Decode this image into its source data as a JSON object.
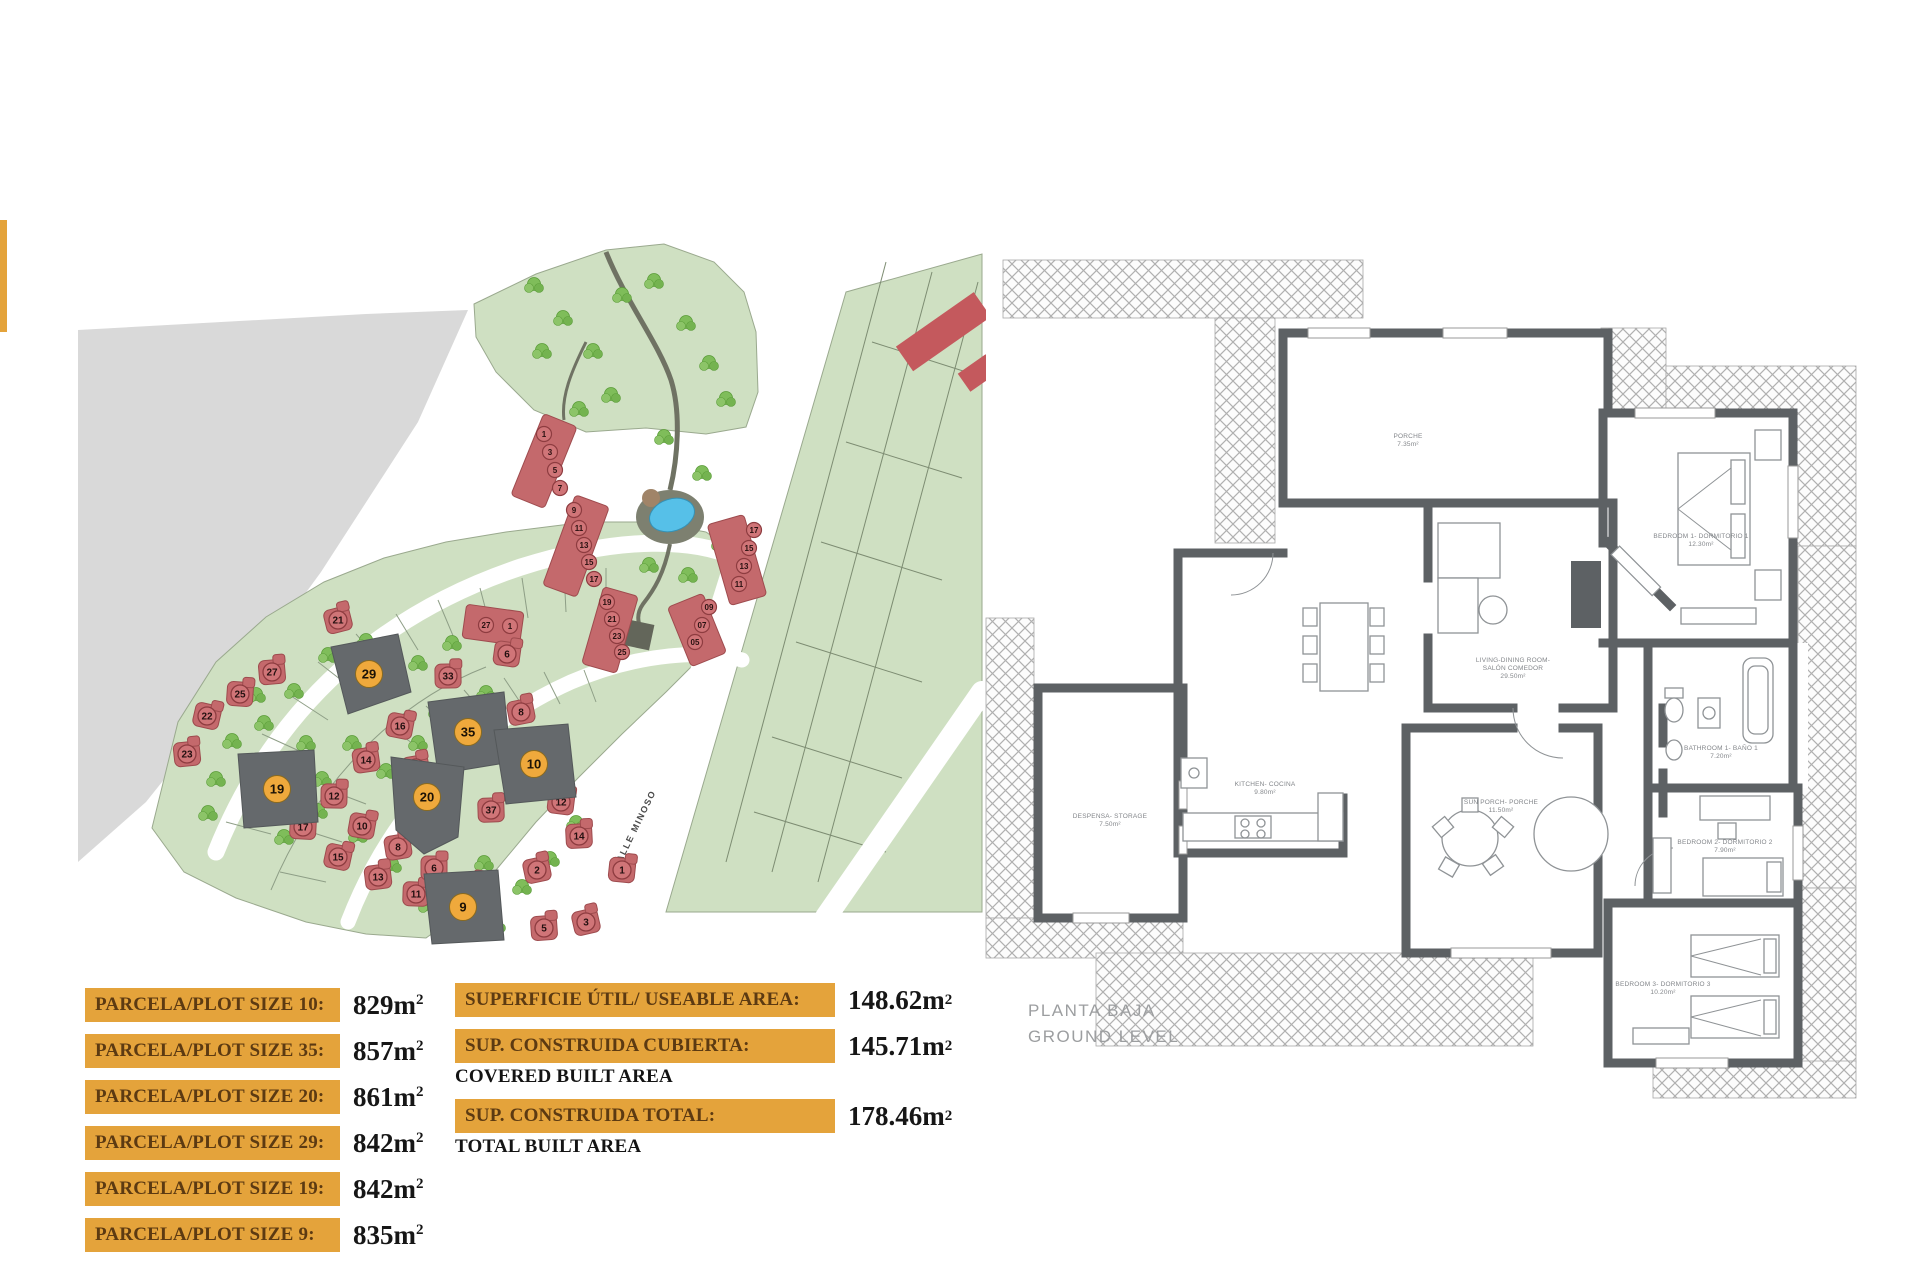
{
  "colors": {
    "table_orange": "#E4A33B",
    "table_text": "#5C3A12",
    "value_text": "#161616",
    "site_green": "#cfe0c2",
    "site_gray": "#d9d9d9",
    "house_red": "#c4696c",
    "marker_orange": "#EFA93C",
    "dark_plot": "#65696c",
    "pool_blue": "#56c0e8",
    "wall": "#5d6164",
    "hatch": "#b0b0b0",
    "label_gray": "#83868a",
    "title_gray": "#9c9ea0"
  },
  "plot_table": {
    "rows": [
      {
        "label": "PARCELA/PLOT SIZE 10:",
        "value": "829",
        "unit": "m",
        "sup": "2"
      },
      {
        "label": "PARCELA/PLOT SIZE 35:",
        "value": "857",
        "unit": "m",
        "sup": "2"
      },
      {
        "label": "PARCELA/PLOT SIZE 20:",
        "value": "861",
        "unit": "m",
        "sup": "2"
      },
      {
        "label": "PARCELA/PLOT SIZE 29:",
        "value": "842",
        "unit": "m",
        "sup": "2"
      },
      {
        "label": "PARCELA/PLOT SIZE 19:",
        "value": "842",
        "unit": "m",
        "sup": "2"
      },
      {
        "label": "PARCELA/PLOT SIZE 9:",
        "value": "835",
        "unit": "m",
        "sup": "2"
      }
    ]
  },
  "area_table": {
    "rows": [
      {
        "label": "SUPERFICIE ÚTIL/ USEABLE AREA:",
        "sublabel": "",
        "value": "148.62",
        "unit": "m",
        "sup": "2"
      },
      {
        "label": "SUP. CONSTRUIDA CUBIERTA:",
        "sublabel": "COVERED BUILT AREA",
        "value": "145.71",
        "unit": "m",
        "sup": "2"
      },
      {
        "label": "SUP. CONSTRUIDA TOTAL:",
        "sublabel": "TOTAL BUILT AREA",
        "value": "178.46",
        "unit": "m",
        "sup": "2"
      }
    ]
  },
  "site_plan": {
    "street_label": "CALLE MINOSO",
    "highlighted_plots": [
      "29",
      "35",
      "10",
      "20",
      "19",
      "9"
    ],
    "house_markers": [
      {
        "n": "21",
        "x": 272,
        "y": 398
      },
      {
        "n": "27",
        "x": 206,
        "y": 450
      },
      {
        "n": "25",
        "x": 174,
        "y": 472
      },
      {
        "n": "22",
        "x": 141,
        "y": 494
      },
      {
        "n": "23",
        "x": 121,
        "y": 532
      },
      {
        "n": "17",
        "x": 237,
        "y": 605
      },
      {
        "n": "15",
        "x": 272,
        "y": 635
      },
      {
        "n": "13",
        "x": 312,
        "y": 655
      },
      {
        "n": "11",
        "x": 350,
        "y": 672
      },
      {
        "n": "16",
        "x": 334,
        "y": 504
      },
      {
        "n": "14",
        "x": 300,
        "y": 538
      },
      {
        "n": "12",
        "x": 268,
        "y": 574
      },
      {
        "n": "10",
        "x": 296,
        "y": 604
      },
      {
        "n": "8",
        "x": 332,
        "y": 625
      },
      {
        "n": "6",
        "x": 368,
        "y": 646
      },
      {
        "n": "4",
        "x": 404,
        "y": 664
      },
      {
        "n": "18",
        "x": 350,
        "y": 546
      },
      {
        "n": "33",
        "x": 382,
        "y": 454
      },
      {
        "n": "6",
        "x": 441,
        "y": 432
      },
      {
        "n": "8",
        "x": 455,
        "y": 490
      },
      {
        "n": "37",
        "x": 425,
        "y": 588
      },
      {
        "n": "12",
        "x": 495,
        "y": 580
      },
      {
        "n": "2",
        "x": 471,
        "y": 648
      },
      {
        "n": "14",
        "x": 513,
        "y": 614
      },
      {
        "n": "1",
        "x": 556,
        "y": 648
      },
      {
        "n": "3",
        "x": 520,
        "y": 700
      },
      {
        "n": "5",
        "x": 478,
        "y": 706
      }
    ],
    "townhouse_units": [
      {
        "n": "1",
        "x": 478,
        "y": 212
      },
      {
        "n": "3",
        "x": 484,
        "y": 230
      },
      {
        "n": "5",
        "x": 489,
        "y": 248
      },
      {
        "n": "7",
        "x": 494,
        "y": 266
      },
      {
        "n": "9",
        "x": 508,
        "y": 288
      },
      {
        "n": "11",
        "x": 513,
        "y": 306
      },
      {
        "n": "13",
        "x": 518,
        "y": 323
      },
      {
        "n": "15",
        "x": 523,
        "y": 340
      },
      {
        "n": "17",
        "x": 528,
        "y": 357
      },
      {
        "n": "19",
        "x": 541,
        "y": 380
      },
      {
        "n": "21",
        "x": 546,
        "y": 397
      },
      {
        "n": "23",
        "x": 551,
        "y": 414
      },
      {
        "n": "25",
        "x": 556,
        "y": 430
      },
      {
        "n": "17",
        "x": 688,
        "y": 308
      },
      {
        "n": "15",
        "x": 683,
        "y": 326
      },
      {
        "n": "13",
        "x": 678,
        "y": 344
      },
      {
        "n": "11",
        "x": 673,
        "y": 362
      },
      {
        "n": "09",
        "x": 643,
        "y": 385
      },
      {
        "n": "07",
        "x": 636,
        "y": 403
      },
      {
        "n": "05",
        "x": 629,
        "y": 420
      },
      {
        "n": "27",
        "x": 420,
        "y": 403
      },
      {
        "n": "1",
        "x": 444,
        "y": 404
      }
    ]
  },
  "floor_plan": {
    "title1": "PLANTA BAJA",
    "title2": "GROUND LEVEL",
    "room_labels": [
      {
        "x": 435,
        "y": 200,
        "lines": [
          "PORCHE",
          "7.35m²"
        ]
      },
      {
        "x": 540,
        "y": 424,
        "lines": [
          "LIVING-DINING ROOM-",
          "SALÓN COMEDOR",
          "29.50m²"
        ]
      },
      {
        "x": 292,
        "y": 548,
        "lines": [
          "KITCHEN- COCINA",
          "9.80m²"
        ]
      },
      {
        "x": 137,
        "y": 580,
        "lines": [
          "DESPENSA- STORAGE",
          "7.50m²"
        ]
      },
      {
        "x": 728,
        "y": 300,
        "lines": [
          "BEDROOM 1- DORMITORIO 1",
          "12.30m²"
        ]
      },
      {
        "x": 748,
        "y": 512,
        "lines": [
          "BATHROOM 1- BAÑO 1",
          "7.20m²"
        ]
      },
      {
        "x": 752,
        "y": 606,
        "lines": [
          "BEDROOM 2- DORMITORIO 2",
          "7.90m²"
        ]
      },
      {
        "x": 690,
        "y": 748,
        "lines": [
          "BEDROOM 3- DORMITORIO 3",
          "10.20m²"
        ]
      },
      {
        "x": 528,
        "y": 566,
        "lines": [
          "SUN PORCH- PORCHE",
          "11.50m²"
        ]
      }
    ]
  }
}
